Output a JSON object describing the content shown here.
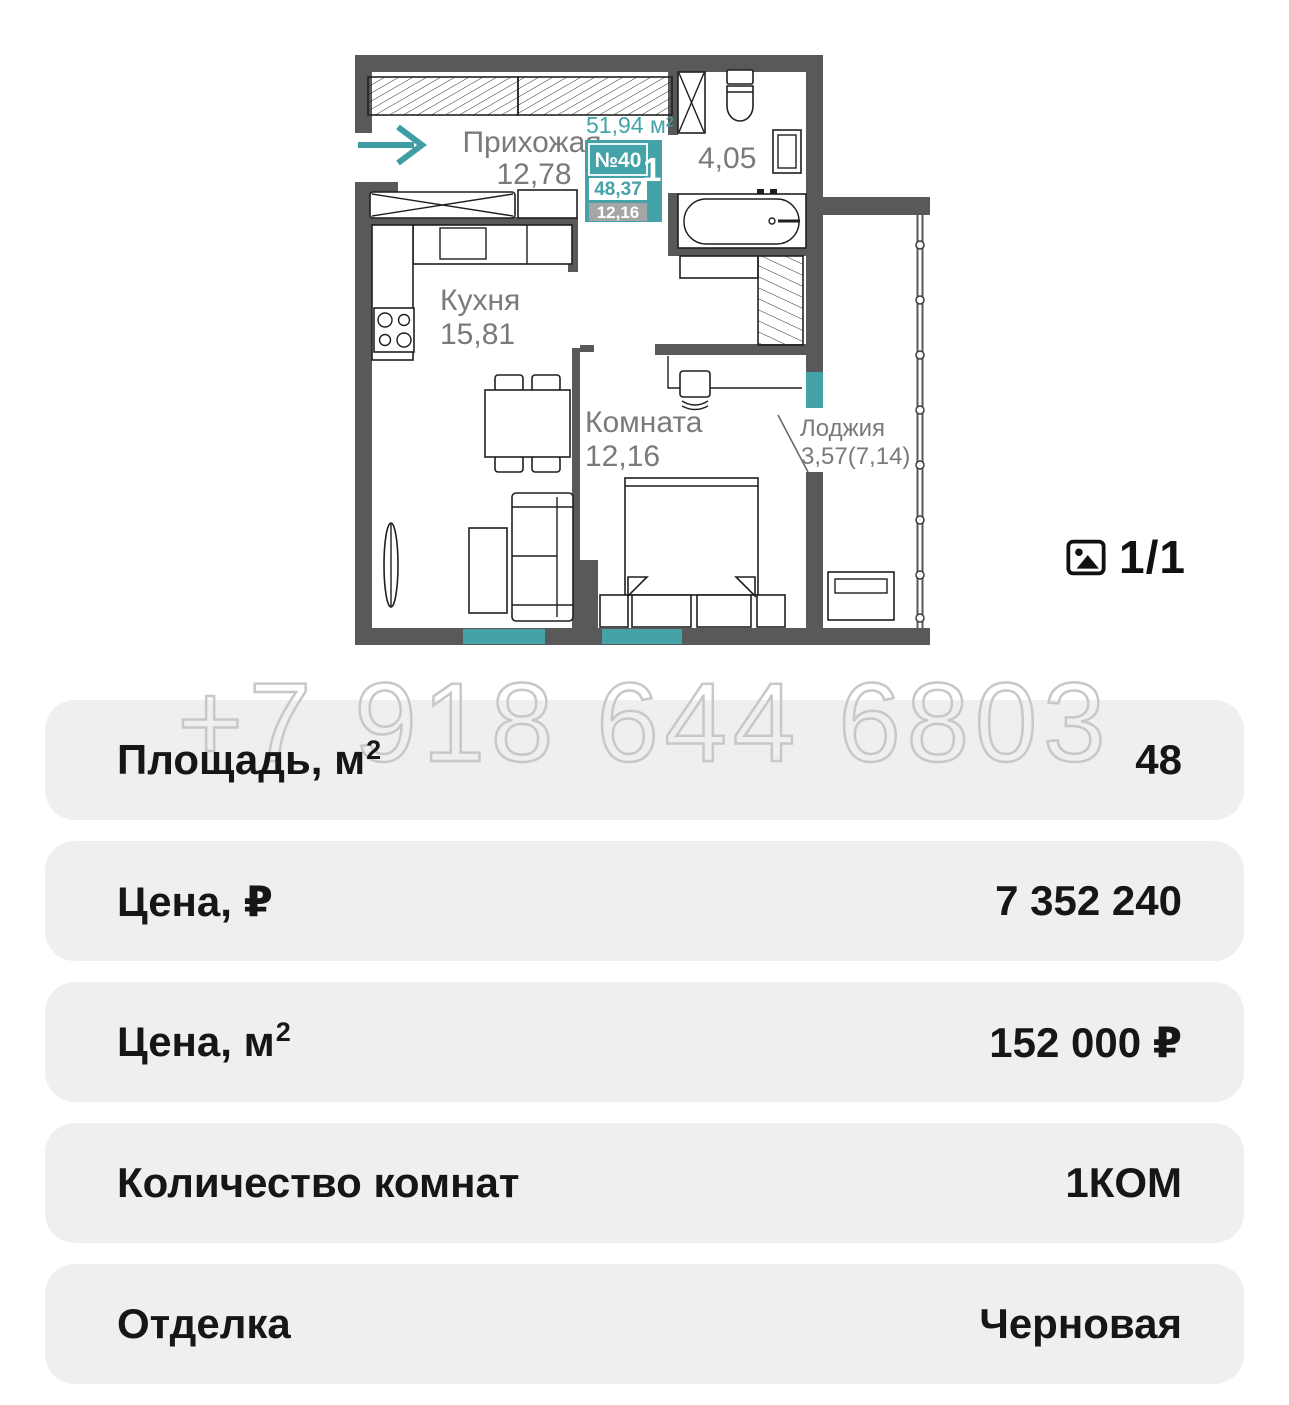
{
  "colors": {
    "accent_teal": "#44a3a8",
    "wall_gray": "#595959",
    "label_gray": "#7a7a7a",
    "row_background": "#efefef",
    "watermark_gray": "#c8c8c8",
    "badge_gray": "#a5a5a5"
  },
  "floor_plan": {
    "total_area_label": "51,94 м²",
    "badge": {
      "number": "№40",
      "rooms_value": "1",
      "rooms_unit": "к",
      "area_total": "48,37",
      "area_living": "12,16"
    },
    "rooms": {
      "hallway": {
        "name": "Прихожая",
        "area": "12,78"
      },
      "kitchen": {
        "name": "Кухня",
        "area": "15,81"
      },
      "room": {
        "name": "Комната",
        "area": "12,16"
      },
      "loggia": {
        "name": "Лоджия",
        "area": "3,57(7,14)"
      },
      "bathroom": {
        "area": "4,05"
      }
    }
  },
  "gallery": {
    "counter": "1/1",
    "icon": "image-icon"
  },
  "watermark": {
    "text": "+7 918 644 6803"
  },
  "details_rows": [
    {
      "label": "Площадь, м",
      "label_sup": "2",
      "value": "48"
    },
    {
      "label": "Цена, ₽",
      "label_sup": "",
      "value": "7 352 240"
    },
    {
      "label": "Цена, м",
      "label_sup": "2",
      "value": "152 000 ₽"
    },
    {
      "label": "Количество комнат",
      "label_sup": "",
      "value": "1КОМ"
    },
    {
      "label": "Отделка",
      "label_sup": "",
      "value": "Черновая"
    }
  ]
}
